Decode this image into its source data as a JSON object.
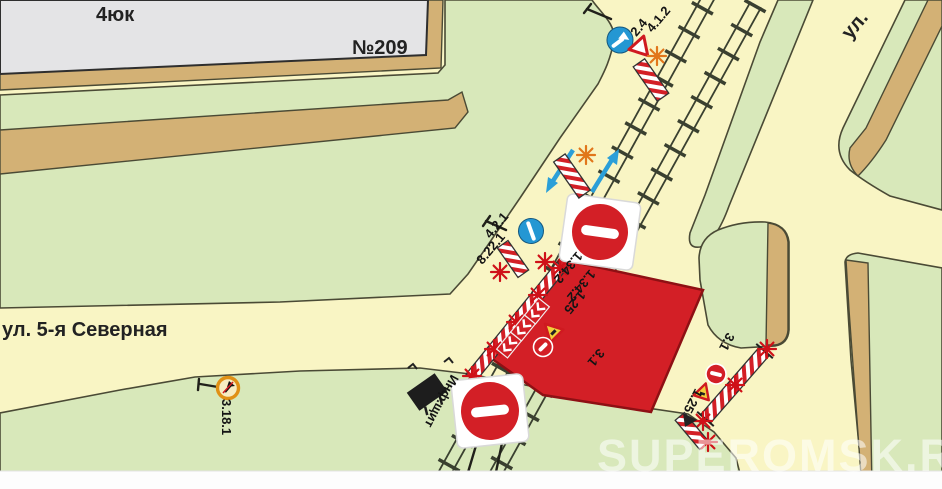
{
  "map": {
    "building": {
      "label": "4юк",
      "number": "№209"
    },
    "streets": {
      "left": "ул. 5-я Северная",
      "top_right": "ул."
    },
    "watermark": "SUPEROMSK.RU"
  },
  "sign_labels": {
    "give_way": "2.4",
    "mandatory_right": "4.1.2",
    "pass_obstacle": "4.2.1",
    "obstacle_plate": "8.22.1",
    "chevron_a": "1.34.2",
    "chevron_b": "1.34.2",
    "road_works_left": "1.25",
    "no_entry_left": "3.1",
    "no_entry_right": "3.1",
    "road_works_right": "1.25",
    "no_turn_right": "3.18.1",
    "info_board": "Инф.щит"
  },
  "colors": {
    "road": "#f9f5c4",
    "green": "#d8e8ba",
    "tan": "#d3b175",
    "outline": "#4a4a35",
    "building": "#e4e4e6",
    "red": "#d31f26",
    "red-dark": "#8e1014",
    "blue": "#2497d3",
    "orange-lamp": "#e1761b",
    "red-lamp": "#cf1118"
  }
}
